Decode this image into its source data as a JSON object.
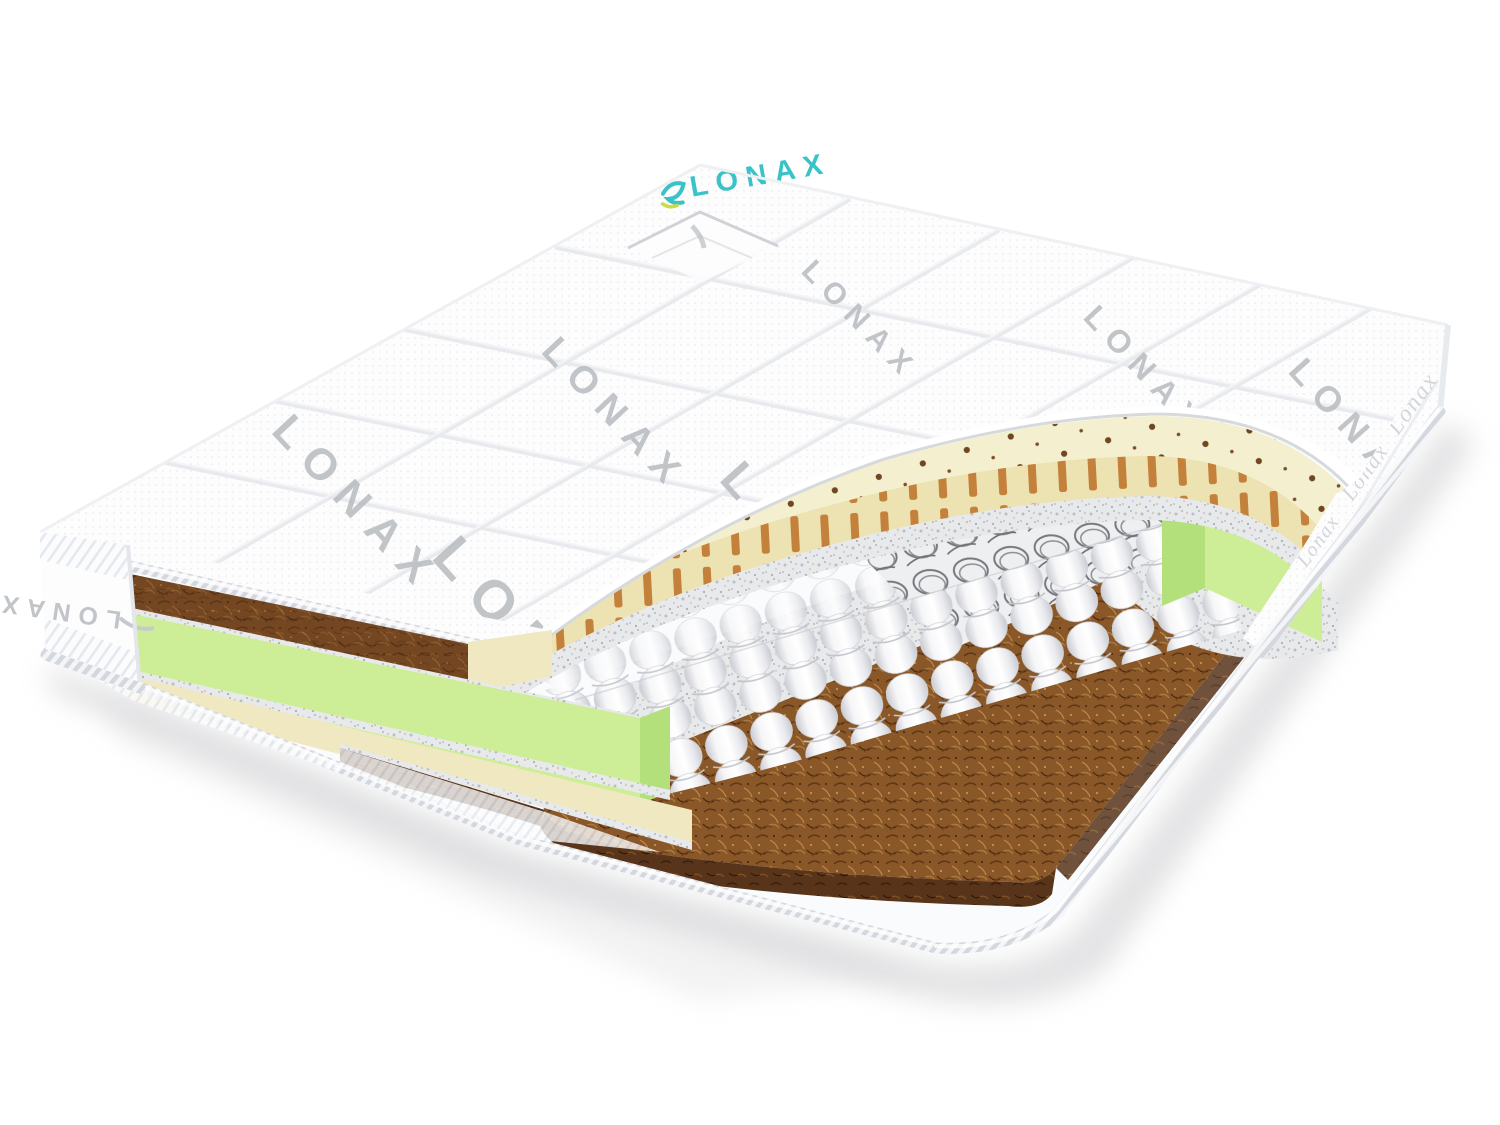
{
  "brand": {
    "logo_text": "LONAX"
  },
  "fabric_watermarks": {
    "top_cover": [
      "LONAX",
      "LONAX",
      "LONAX",
      "LONAX",
      "LONAX",
      "LONAX",
      "LONAX"
    ],
    "right_side_band": [
      "Lonax",
      "Lonax",
      "Lonax"
    ],
    "left_side_band": "LONAX"
  },
  "colors": {
    "background": "#ffffff",
    "fabric_white": "#fdfdfe",
    "quilt_seam": "#e7e9ec",
    "watermark_gray": "#b7bbbf",
    "logo_teal": "#3ac3c7",
    "logo_leaf_green": "#cbdc3f",
    "latex_cream": "#f4efcf",
    "latex_edge_stripe": "#c0762e",
    "latex_hole_brown": "#6e4620",
    "foam_green": "#cdee96",
    "foam_green_dark": "#b4e07c",
    "felt_gray": "#e7e9eb",
    "spring_pocket_white": "#f2f2f4",
    "spring_coil_gray": "#75787c",
    "coir_brown": "#8a5728",
    "coir_brown_dark": "#5d3917",
    "base_white": "#fafbfc",
    "shadow_gray": "#cdced0"
  }
}
